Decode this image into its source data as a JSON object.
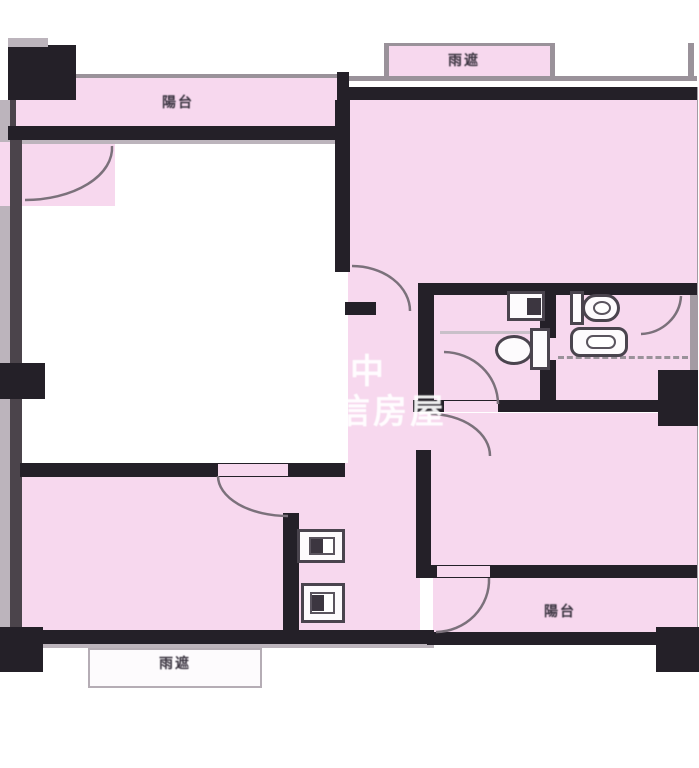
{
  "title": "apartment-floor-plan",
  "labels": {
    "balcony_top": "陽台",
    "canopy_top": "雨遮",
    "balcony_bottom_right": "陽台",
    "canopy_bottom": "雨遮"
  },
  "watermark": {
    "line1": "中",
    "line2": "信房屋"
  },
  "colors": {
    "room_fill": "#f7d8ee",
    "wall": "#242028",
    "line": "#9a929a",
    "watermark_text": "#ffffff"
  }
}
